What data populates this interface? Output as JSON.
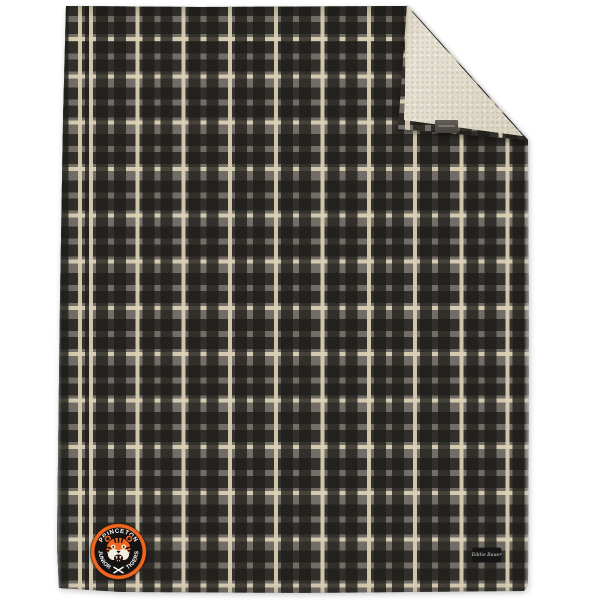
{
  "scene": {
    "description": "product-photo of plaid sherpa-lined throw blanket with folded corner",
    "background_color": "#ffffff"
  },
  "blanket": {
    "plaid_colors": {
      "base": "#716c65",
      "dark": "#1a1815",
      "cream": "#e0d6b8"
    },
    "sherpa_color": "#e2dccd",
    "fold_tag_color": "#55524b"
  },
  "badge": {
    "top_text": "PRINCETON",
    "left_text": "JUNIOR",
    "right_text": "TIGERS",
    "center_icon": "tiger-head",
    "bottom_icon": "crossed-hockey-sticks",
    "ring_color": "#ef6621",
    "band_color": "#161412",
    "text_color": "#ffffff"
  },
  "brand_label": {
    "text": "Eddie Bauer",
    "bg_color": "#161616",
    "text_color": "#d9d9d9"
  }
}
